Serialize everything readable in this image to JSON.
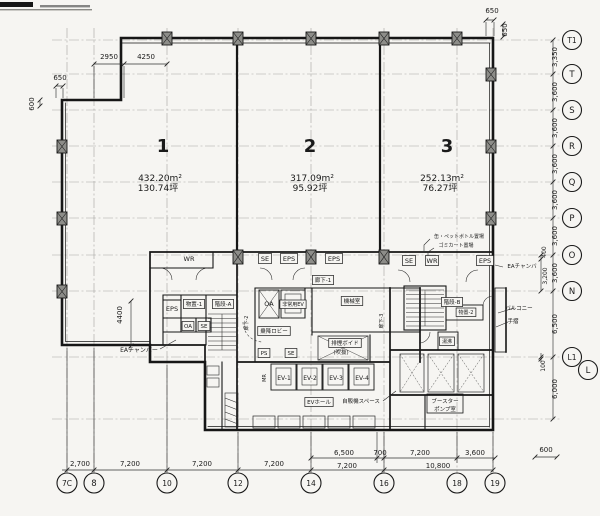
{
  "colors": {
    "paper": "#f6f5f2",
    "ink": "#1a1a1a",
    "grid": "#9b9b97",
    "dim": "#333333"
  },
  "zones": [
    {
      "number": "1",
      "area_m2": "432.20m²",
      "area_tsubo": "130.74坪",
      "x": 163,
      "y": 152,
      "ax": 160,
      "ay": 181
    },
    {
      "number": "2",
      "area_m2": "317.09m²",
      "area_tsubo": "95.92坪",
      "x": 310,
      "y": 152,
      "ax": 312,
      "ay": 181
    },
    {
      "number": "3",
      "area_m2": "252.13m²",
      "area_tsubo": "76.27坪",
      "x": 447,
      "y": 152,
      "ax": 442,
      "ay": 181
    }
  ],
  "grid_bubbles": {
    "bottom": [
      {
        "t": "7C",
        "x": 67
      },
      {
        "t": "8",
        "x": 94
      },
      {
        "t": "10",
        "x": 167
      },
      {
        "t": "12",
        "x": 238
      },
      {
        "t": "14",
        "x": 311
      },
      {
        "t": "16",
        "x": 384
      },
      {
        "t": "18",
        "x": 457
      },
      {
        "t": "19",
        "x": 495
      }
    ],
    "right": [
      {
        "t": "T1",
        "y": 40
      },
      {
        "t": "T",
        "y": 74
      },
      {
        "t": "S",
        "y": 110
      },
      {
        "t": "R",
        "y": 146
      },
      {
        "t": "Q",
        "y": 182
      },
      {
        "t": "P",
        "y": 218
      },
      {
        "t": "O",
        "y": 255
      },
      {
        "t": "N",
        "y": 291
      },
      {
        "t": "L1",
        "y": 357
      },
      {
        "t": "L",
        "y": 370,
        "x": 588
      }
    ]
  },
  "dim_labels": [
    {
      "t": "2950",
      "x": 109,
      "y": 59
    },
    {
      "t": "4250",
      "x": 146,
      "y": 59
    },
    {
      "t": "650",
      "x": 60,
      "y": 80
    },
    {
      "t": "600",
      "x": 34,
      "y": 104,
      "v": 1
    },
    {
      "t": "650",
      "x": 492,
      "y": 13
    },
    {
      "t": "650",
      "x": 507,
      "y": 30,
      "v": 1
    },
    {
      "t": "4400",
      "x": 122,
      "y": 315,
      "v": 1
    },
    {
      "t": "3,350",
      "x": 557,
      "y": 57,
      "v": 1
    },
    {
      "t": "3,600",
      "x": 557,
      "y": 92,
      "v": 1
    },
    {
      "t": "3,600",
      "x": 557,
      "y": 128,
      "v": 1
    },
    {
      "t": "3,600",
      "x": 557,
      "y": 164,
      "v": 1
    },
    {
      "t": "3,600",
      "x": 557,
      "y": 200,
      "v": 1
    },
    {
      "t": "3,600",
      "x": 557,
      "y": 236,
      "v": 1
    },
    {
      "t": "400",
      "x": 546,
      "y": 252,
      "v": 1,
      "s": 6
    },
    {
      "t": "3,600",
      "x": 557,
      "y": 273,
      "v": 1
    },
    {
      "t": "3,200",
      "x": 547,
      "y": 276,
      "v": 1,
      "s": 6
    },
    {
      "t": "6,500",
      "x": 557,
      "y": 324,
      "v": 1
    },
    {
      "t": "100",
      "x": 545,
      "y": 366,
      "v": 1,
      "s": 6
    },
    {
      "t": "6,000",
      "x": 557,
      "y": 389,
      "v": 1
    },
    {
      "t": "600",
      "x": 546,
      "y": 452
    },
    {
      "t": "2,700",
      "x": 80,
      "y": 466
    },
    {
      "t": "7,200",
      "x": 130,
      "y": 466
    },
    {
      "t": "7,200",
      "x": 202,
      "y": 466
    },
    {
      "t": "7,200",
      "x": 274,
      "y": 466
    },
    {
      "t": "6,500",
      "x": 344,
      "y": 455
    },
    {
      "t": "700",
      "x": 380,
      "y": 455
    },
    {
      "t": "7,200",
      "x": 420,
      "y": 455
    },
    {
      "t": "3,600",
      "x": 475,
      "y": 455
    },
    {
      "t": "7,200",
      "x": 347,
      "y": 468
    },
    {
      "t": "10,800",
      "x": 438,
      "y": 468
    }
  ],
  "room_labels": [
    {
      "t": "WR",
      "x": 189,
      "y": 261
    },
    {
      "t": "SE",
      "x": 265,
      "y": 261,
      "b": 1
    },
    {
      "t": "EPS",
      "x": 289,
      "y": 261,
      "b": 1
    },
    {
      "t": "EPS",
      "x": 334,
      "y": 261,
      "b": 1
    },
    {
      "t": "SE",
      "x": 409,
      "y": 263,
      "b": 1
    },
    {
      "t": "WR",
      "x": 432,
      "y": 263,
      "b": 1
    },
    {
      "t": "EPS",
      "x": 485,
      "y": 263,
      "b": 1
    },
    {
      "t": "廊下-1",
      "x": 323,
      "y": 282,
      "b": 1,
      "s": 5.5
    },
    {
      "t": "物置-1",
      "x": 194,
      "y": 306,
      "b": 1,
      "s": 5.5
    },
    {
      "t": "階段-A",
      "x": 223,
      "y": 306,
      "b": 1,
      "s": 5.5
    },
    {
      "t": "EPS",
      "x": 172,
      "y": 311
    },
    {
      "t": "OA",
      "x": 188,
      "y": 328,
      "b": 1,
      "s": 5.5
    },
    {
      "t": "SE",
      "x": 204,
      "y": 328,
      "b": 1,
      "s": 5.5
    },
    {
      "t": "OA",
      "x": 269,
      "y": 306
    },
    {
      "t": "非常用EV",
      "x": 293,
      "y": 306,
      "b": 1,
      "s": 5
    },
    {
      "t": "機械室",
      "x": 352,
      "y": 303,
      "b": 1,
      "s": 5.5
    },
    {
      "t": "乗降ロビー",
      "x": 274,
      "y": 333,
      "b": 1,
      "s": 5.5
    },
    {
      "t": "廊下-2",
      "x": 248,
      "y": 323,
      "v": 1,
      "s": 5
    },
    {
      "t": "廊下-3",
      "x": 383,
      "y": 321,
      "v": 1,
      "s": 5
    },
    {
      "t": "排煙ボイド",
      "x": 345,
      "y": 345,
      "b": 1,
      "s": 5.5
    },
    {
      "t": "(吹抜)",
      "x": 341,
      "y": 354,
      "s": 5.5
    },
    {
      "t": "PS",
      "x": 264,
      "y": 355,
      "b": 1,
      "s": 5.5
    },
    {
      "t": "SE",
      "x": 291,
      "y": 355,
      "b": 1,
      "s": 5.5
    },
    {
      "t": "MR",
      "x": 266,
      "y": 378,
      "v": 1,
      "s": 5
    },
    {
      "t": "EV-1",
      "x": 284,
      "y": 380,
      "s": 6
    },
    {
      "t": "EV-2",
      "x": 310,
      "y": 380,
      "s": 6
    },
    {
      "t": "EV-3",
      "x": 336,
      "y": 380,
      "s": 6
    },
    {
      "t": "EV-4",
      "x": 362,
      "y": 380,
      "s": 6
    },
    {
      "t": "EVホール",
      "x": 319,
      "y": 404,
      "b": 1,
      "s": 5.5
    },
    {
      "t": "自販機スペース",
      "x": 361,
      "y": 403,
      "s": 5.5
    },
    {
      "t": "階段-B",
      "x": 452,
      "y": 304,
      "b": 1,
      "s": 5.5
    },
    {
      "t": "物置-2",
      "x": 466,
      "y": 314,
      "b": 1,
      "s": 5
    },
    {
      "t": "湯沸",
      "x": 447,
      "y": 343,
      "b": 1,
      "s": 5
    },
    {
      "t": "ブースター",
      "x": 445,
      "y": 403,
      "s": 5.5
    },
    {
      "t": "ポンプ室",
      "x": 445,
      "y": 411,
      "s": 5.5
    },
    {
      "t": "バルコニー",
      "x": 519,
      "y": 310,
      "s": 5.5
    },
    {
      "t": "手摺",
      "x": 513,
      "y": 323,
      "s": 5.5
    },
    {
      "t": "EAチャンバー",
      "x": 139,
      "y": 352,
      "s": 6
    },
    {
      "t": "EAチャンバ",
      "x": 522,
      "y": 268,
      "s": 5.5
    },
    {
      "t": "缶・ペットボトル置場",
      "x": 459,
      "y": 238,
      "s": 5
    },
    {
      "t": "ゴミカート置場",
      "x": 456,
      "y": 247,
      "s": 5
    }
  ]
}
